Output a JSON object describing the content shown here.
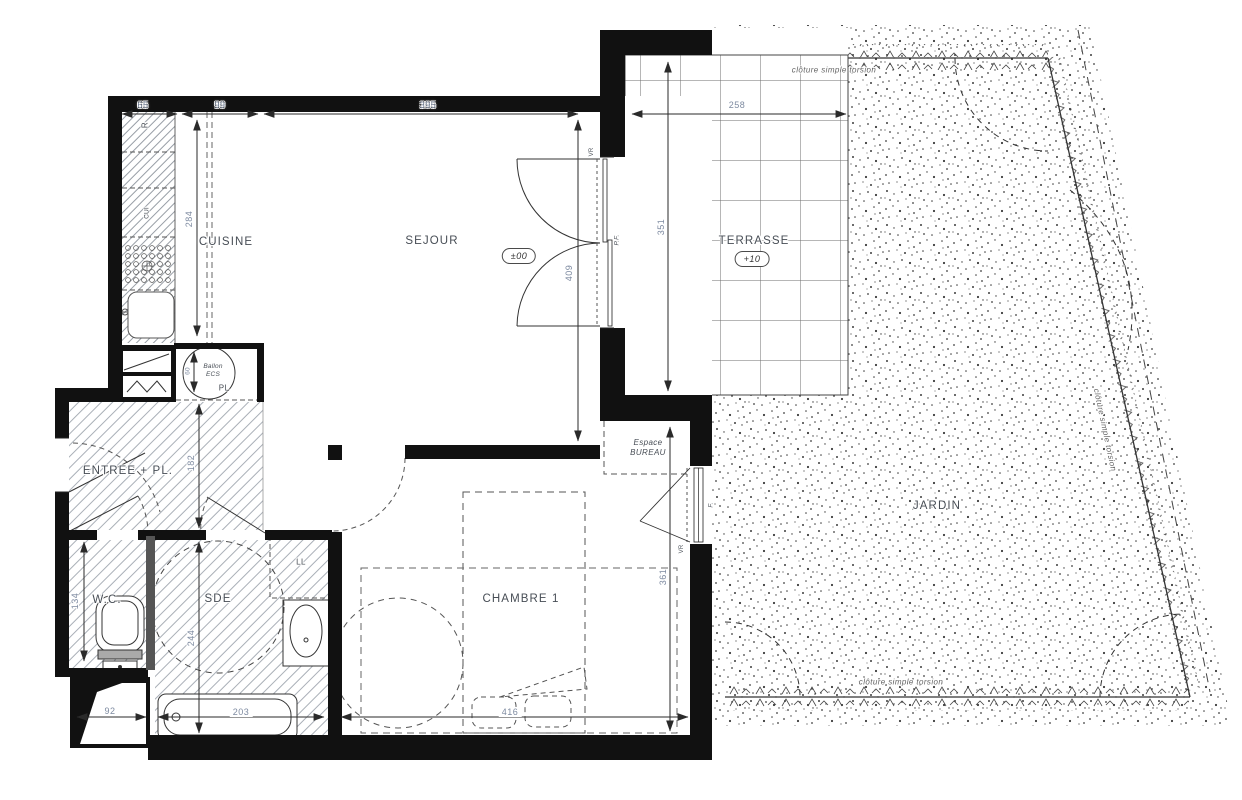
{
  "plan": {
    "colors": {
      "dim_text": "#7d8aa0",
      "room_text": "#474d55",
      "line": "#2a2a2a",
      "wall": "#111111"
    },
    "rooms": {
      "cuisine": "CUISINE",
      "sejour": "SEJOUR",
      "terrasse": "TERRASSE",
      "jardin": "JARDIN",
      "entree": "ENTREE + PL.",
      "wc": "W.C.",
      "sde": "SDE",
      "chambre": "CHAMBRE 1",
      "espace_bureau": "Espace\nBUREAU"
    },
    "levels": {
      "sejour": "±00",
      "terrasse": "+10"
    },
    "fixtures": {
      "ballon_ecs": "Ballon\nECS",
      "placard": "PL",
      "lave_linge": "LL",
      "refrigerateur": "R",
      "cuisson": "CUI"
    },
    "openings": {
      "porte_fenetre": "P.F.",
      "fenetre": "F.",
      "volet_roulant_sejour": "VR",
      "volet_roulant_chambre": "VR"
    },
    "dimensions": {
      "d65": "65",
      "d99": "99",
      "d395": "395",
      "d258": "258",
      "d284": "284",
      "d409": "409",
      "d351": "351",
      "d361": "361",
      "d416": "416",
      "d182": "182",
      "d244": "244",
      "d134": "134",
      "d92": "92",
      "d203": "203",
      "d60": "60"
    },
    "annotations": {
      "fence_top": "clôture simple torsion",
      "fence_right": "clôture simple torsion",
      "fence_bottom": "clôture simple torsion"
    }
  }
}
